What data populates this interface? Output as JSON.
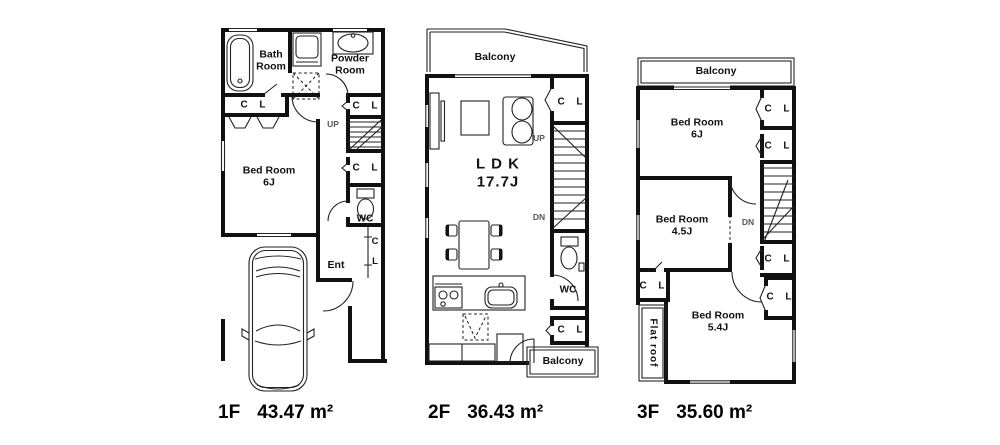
{
  "colors": {
    "wall": "#111111",
    "fixture": "#222222",
    "muted_label": "#555555",
    "background": "#ffffff"
  },
  "floors": [
    {
      "id": "1F",
      "footer": {
        "name": "1F",
        "area": "43.47 m²"
      },
      "labels": {
        "bath": "Bath\nRoom",
        "powder": "Powder\nRoom",
        "closet_bath": "C  L",
        "bedroom": "Bed Room\n6J",
        "up": "UP",
        "closet_right_top": "C  L",
        "closet_mid": "C  L",
        "wc": "WC",
        "closet_vertical": "C\nL",
        "entrance": "Ent"
      }
    },
    {
      "id": "2F",
      "footer": {
        "name": "2F",
        "area": "36.43 m²"
      },
      "labels": {
        "balcony_top": "Balcony",
        "ldk": "L D K\n17.7J",
        "closet_top": "C  L",
        "up": "UP",
        "dn": "DN",
        "wc": "WC",
        "closet_bottom": "C  L",
        "balcony_bottom": "Balcony"
      }
    },
    {
      "id": "3F",
      "footer": {
        "name": "3F",
        "area": "35.60 m²"
      },
      "labels": {
        "balcony": "Balcony",
        "bedroom6": "Bed Room\n6J",
        "closet1": "C  L",
        "closet2": "C  L",
        "dn": "DN",
        "bedroom45": "Bed Room\n4.5J",
        "closet3": "C  L",
        "closet4": "C  L",
        "closet5": "C  L",
        "bedroom54": "Bed Room\n5.4J",
        "flat_roof": "Flat roof"
      }
    }
  ]
}
